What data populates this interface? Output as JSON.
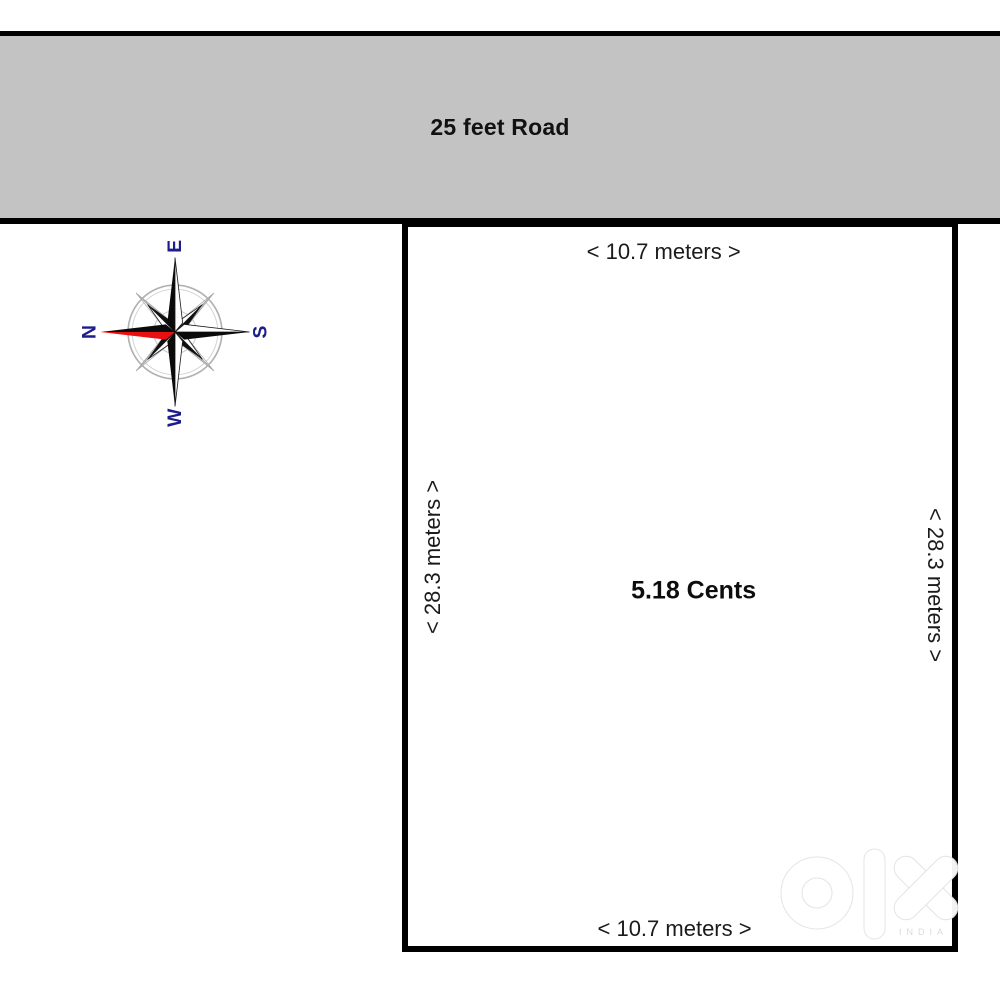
{
  "road": {
    "label": "25 feet Road",
    "fill_color": "#c3c3c3",
    "border_color": "#000000"
  },
  "plot": {
    "area_label": "5.18 Cents",
    "top_dimension": "< 10.7 meters >",
    "bottom_dimension": "< 10.7 meters >",
    "left_dimension": "< 28.3 meters >",
    "right_dimension": "< 28.3 meters >",
    "border_color": "#000000"
  },
  "compass": {
    "north": "N",
    "east": "E",
    "south": "S",
    "west": "W",
    "letter_color": "#1c1c8a",
    "needle_color": "#e81010"
  },
  "watermark": {
    "brand": "olx",
    "country": "INDIA"
  }
}
